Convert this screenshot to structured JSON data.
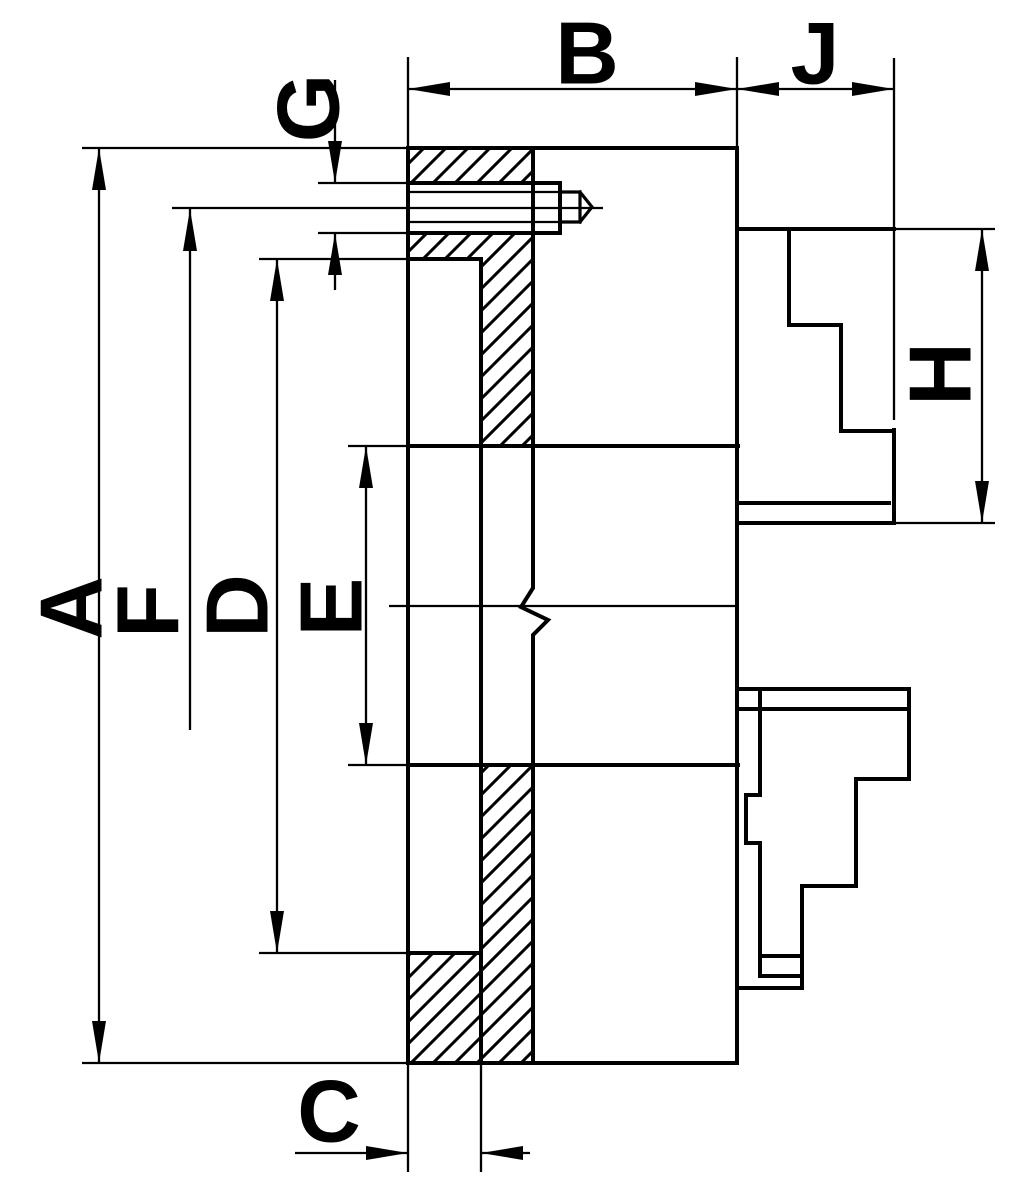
{
  "drawing": {
    "type": "lathe-chuck-cross-section",
    "colors": {
      "background": "#ffffff",
      "line": "#000000"
    },
    "labels": {
      "A": {
        "label": "A"
      },
      "B": {
        "label": "B"
      },
      "C": {
        "label": "C"
      },
      "D": {
        "label": "D"
      },
      "E": {
        "label": "E"
      },
      "F": {
        "label": "F"
      },
      "G": {
        "label": "G"
      },
      "H": {
        "label": "H"
      },
      "J": {
        "label": "J"
      }
    }
  }
}
